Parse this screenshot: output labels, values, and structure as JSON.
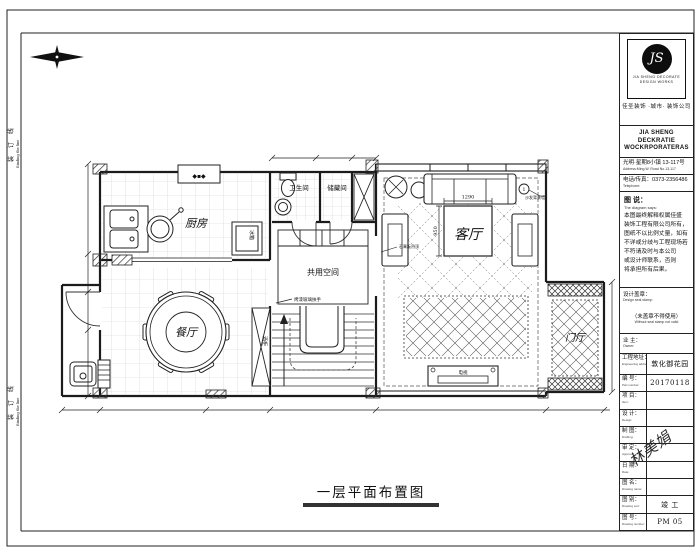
{
  "sheet": {
    "binding_cn": "装 订 线",
    "binding_en": "Binding the line",
    "plan_title": "一层平面布置图"
  },
  "plan": {
    "rooms": {
      "kitchen": "厨房",
      "bath": "卫生间",
      "storage": "储藏间",
      "shared": "共用空间",
      "dining": "餐厅",
      "living": "客厅",
      "foyer": "门厅"
    },
    "notes": {
      "stair_rail": "烤漆玻璃扶手",
      "ceiling": "石膏板吊顶",
      "sofa_wall": "沙发背景墙",
      "fridge": "冰箱",
      "wine": "酒柜",
      "tv": "电视"
    },
    "dims": {
      "table_w": "1290",
      "table_d": "950"
    },
    "keynote": "1",
    "stamp": "◆▪◆"
  },
  "title_block": {
    "emblem": "JS",
    "logo_caption1": "JIA SHENG DECORATE",
    "logo_caption2": "DESIGN WORKS",
    "company_cn": "佳圣装饰 ·城市· 装饰公司",
    "company_en1": "JIA SHENG DECKRATIE",
    "company_en2": "WOCKRPORATERAS",
    "address_cn": "光明·星期8小镇 13-117号",
    "address_en": "Address:Ming.W. Road No.13-117",
    "phone_cn": "电话/传真：0373-2356486",
    "phone_en": "Telephone:",
    "notes_heading_cn": "图 说：",
    "notes_heading_en": "The diagram says:",
    "notes_lines": [
      "本图最终解释权属佳盛",
      "装饰工程有限公司所有，",
      "图纸不以比例丈量，如有",
      "不详或分歧与工程现场若",
      "不符请及时与本公司",
      "或设计师联系，否则",
      "将承担所有后果。"
    ],
    "seal_cn": "设计盖章：",
    "seal_en": "Design seal stamp:",
    "seal_warning_cn": "（未盖章不得使用）",
    "seal_warning_en": "Without seal stamp not valid",
    "owner_cn": "业 主：",
    "owner_en": "Owner:",
    "rows": [
      {
        "cn": "工程地址：",
        "en": "Engineering address:",
        "value": "敦化御花园"
      },
      {
        "cn": "编 号：",
        "en": "Part number:",
        "value": "20170118"
      },
      {
        "cn": "项 目：",
        "en": "Item:",
        "value": ""
      },
      {
        "cn": "设 计：",
        "en": "Design:",
        "value": ""
      },
      {
        "cn": "制 图：",
        "en": "Drafting:",
        "value": ""
      },
      {
        "cn": "审 定：",
        "en": "Approval:",
        "value": ""
      },
      {
        "cn": "日 期：",
        "en": "Date:",
        "value": ""
      },
      {
        "cn": "图 名：",
        "en": "Drawing name:",
        "value": ""
      },
      {
        "cn": "图 别：",
        "en": "Drawing sort:",
        "value": "竣 工"
      },
      {
        "cn": "图 号：",
        "en": "Drawing number:",
        "value": "PM 05"
      }
    ],
    "signature": "林美娟"
  }
}
